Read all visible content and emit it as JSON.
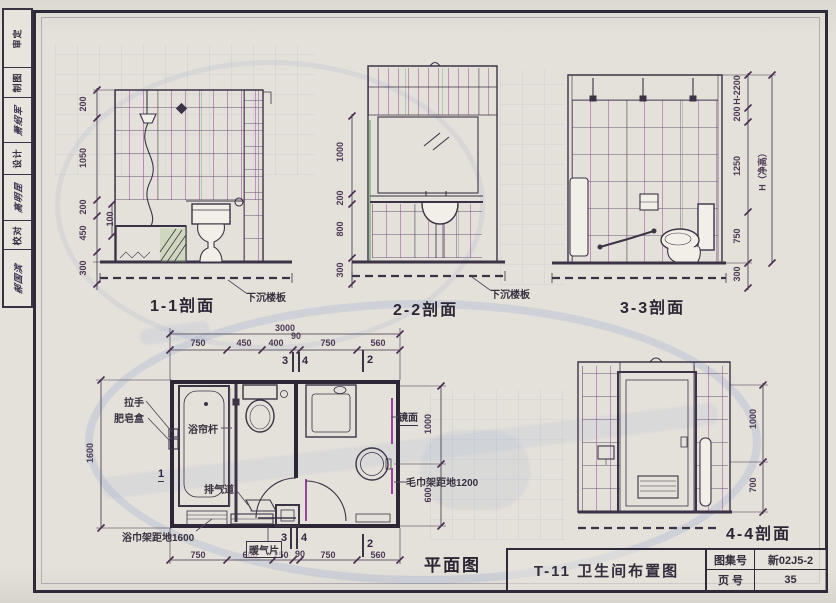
{
  "colors": {
    "paper": "#e4e0da",
    "ink": "#3c3346",
    "magenta": "#9a43a0",
    "green": "#5ea05e",
    "ghost_blue": "#809cce"
  },
  "sidebar": {
    "cells": [
      "审定",
      "制图",
      "萧绍军",
      "设计",
      "高明昆",
      "校对",
      "郝国滨"
    ]
  },
  "titleblock": {
    "drawing_title": "T-11 卫生间布置图",
    "atlas_label": "图集号",
    "atlas_value": "新02J5-2",
    "page_label": "页 号",
    "page_value": "35"
  },
  "s11": {
    "caption": "1-1剖面",
    "callout": "下沉楼板",
    "dims": [
      "200",
      "1050",
      "200",
      "100",
      "450",
      "300"
    ]
  },
  "s22": {
    "caption": "2-2剖面",
    "callout": "下沉楼板",
    "dims": [
      "1000",
      "200",
      "800",
      "300"
    ]
  },
  "s33": {
    "caption": "3-3剖面",
    "dims": [
      "H-2200",
      "200",
      "1250",
      "750",
      "300"
    ],
    "overall": "H（净高）"
  },
  "s44": {
    "caption": "4-4剖面",
    "dims": [
      "1000",
      "700"
    ]
  },
  "plan": {
    "caption": "平面图",
    "total": "3000",
    "top_dims": [
      "750",
      "450",
      "400",
      "90",
      "750",
      "560"
    ],
    "bottom_dims": [
      "750",
      "600",
      "250",
      "90",
      "750",
      "560"
    ],
    "left_dim": "1600",
    "right_dims": [
      "1000",
      "600"
    ],
    "marks": {
      "one": "1",
      "two": "2",
      "three": "3",
      "four": "4"
    },
    "labels": {
      "handle": "拉手",
      "soap_box": "肥皂盒",
      "curtain_rod": "浴帘杆",
      "exhaust": "排气道",
      "mirror": "镜面",
      "towel_rail": "毛巾架距地1200",
      "bath_towel_rack": "浴巾架距地1600",
      "radiator": "暖气片"
    }
  }
}
